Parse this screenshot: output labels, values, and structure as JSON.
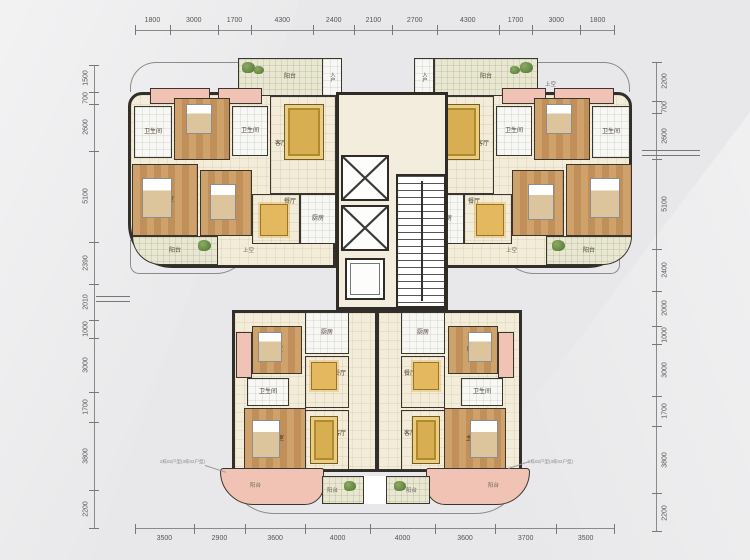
{
  "dimensions": {
    "top": [
      "1800",
      "3000",
      "1700",
      "4300",
      "2400",
      "2100",
      "2700",
      "4300",
      "1700",
      "3000",
      "1800"
    ],
    "bottom": [
      "3500",
      "2900",
      "3600",
      "4000",
      "4000",
      "3600",
      "3700",
      "3500"
    ],
    "left": [
      "1500",
      "700",
      "2600",
      "5100",
      "2390",
      "2010",
      "1000",
      "3000",
      "1700",
      "3800",
      "2200"
    ],
    "right": [
      "2200",
      "700",
      "2600",
      "5100",
      "2400",
      "2000",
      "1000",
      "3000",
      "1700",
      "3800",
      "2200"
    ]
  },
  "labels": {
    "living": "客厅",
    "dining": "餐厅",
    "kitchen": "厨房",
    "master_bedroom": "主卧室",
    "bedroom": "卧室",
    "bathroom": "卫生间",
    "balcony": "阳台",
    "entry": "入户",
    "open_above": "上空"
  },
  "annotations": {
    "unit_note": "2栋02户型(3栋02户型)"
  },
  "colors": {
    "background": "#e8e8ea",
    "wall": "#322e29",
    "floor_cream": "#f2ecd8",
    "wood": "#c89a62",
    "balcony_pink": "#f0c3b5",
    "tile_white": "#f7f7f4",
    "rug_gold": "#d7af52",
    "plant_green": "#6d8f4e",
    "dimension_text": "#555555"
  }
}
